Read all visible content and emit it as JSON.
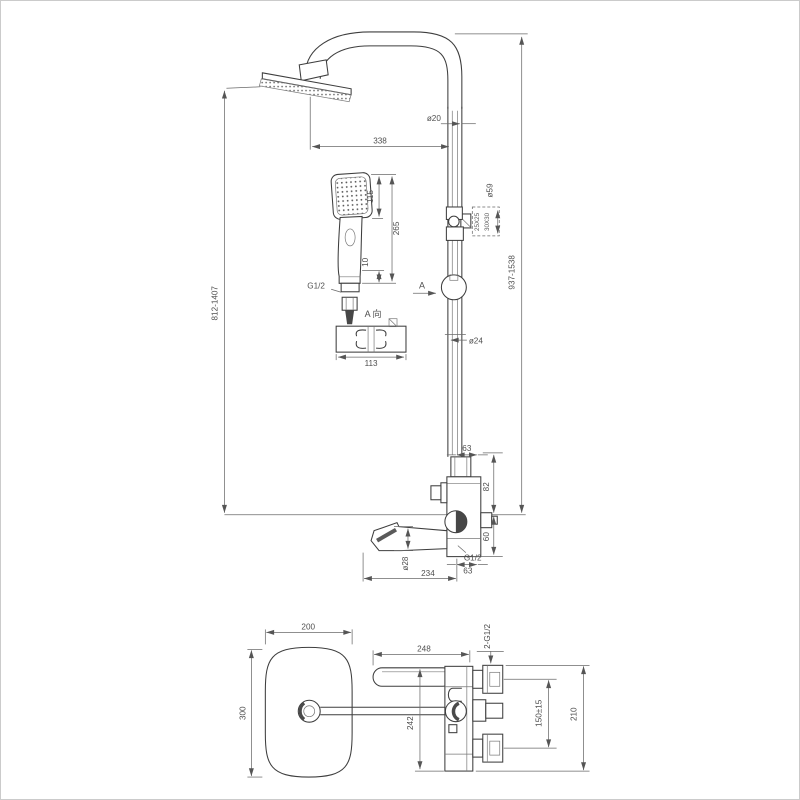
{
  "drawing": {
    "title": "shower-system-technical-drawing",
    "front": {
      "dim_left": "812-1407",
      "dim_right": "937-1538",
      "dim_arm": "338",
      "dia_arm_pipe": "ø20",
      "dia_pipe": "ø24",
      "dia_slider": "ø59",
      "slider_note_line1": "25X25",
      "slider_note_line2": "30X30",
      "section_arrow": "A",
      "hand_shower": {
        "width": "115",
        "length": "265",
        "outlet": "10",
        "thread": "G1/2"
      },
      "bracket_view_label": "A 向",
      "bracket_width": "113",
      "mixer": {
        "top_offset": "63",
        "upper_height": "82",
        "lower_height": "60",
        "outlet_thread": "G1/2",
        "bottom_width": "63",
        "spout_reach": "234",
        "spout_dia": "ø28"
      }
    },
    "plan": {
      "head_width": "200",
      "head_depth": "300",
      "lever_reach": "248",
      "body_span": "242",
      "inlet_thread": "2-G1/2",
      "inlet_spacing": "150±15",
      "overall_depth": "210"
    }
  },
  "colors": {
    "background": "#ffffff",
    "object_line": "#3e3e3e",
    "dimension_line": "#6a6a6a",
    "text": "#4f4f4f",
    "page_border": "#cbcbcb"
  }
}
